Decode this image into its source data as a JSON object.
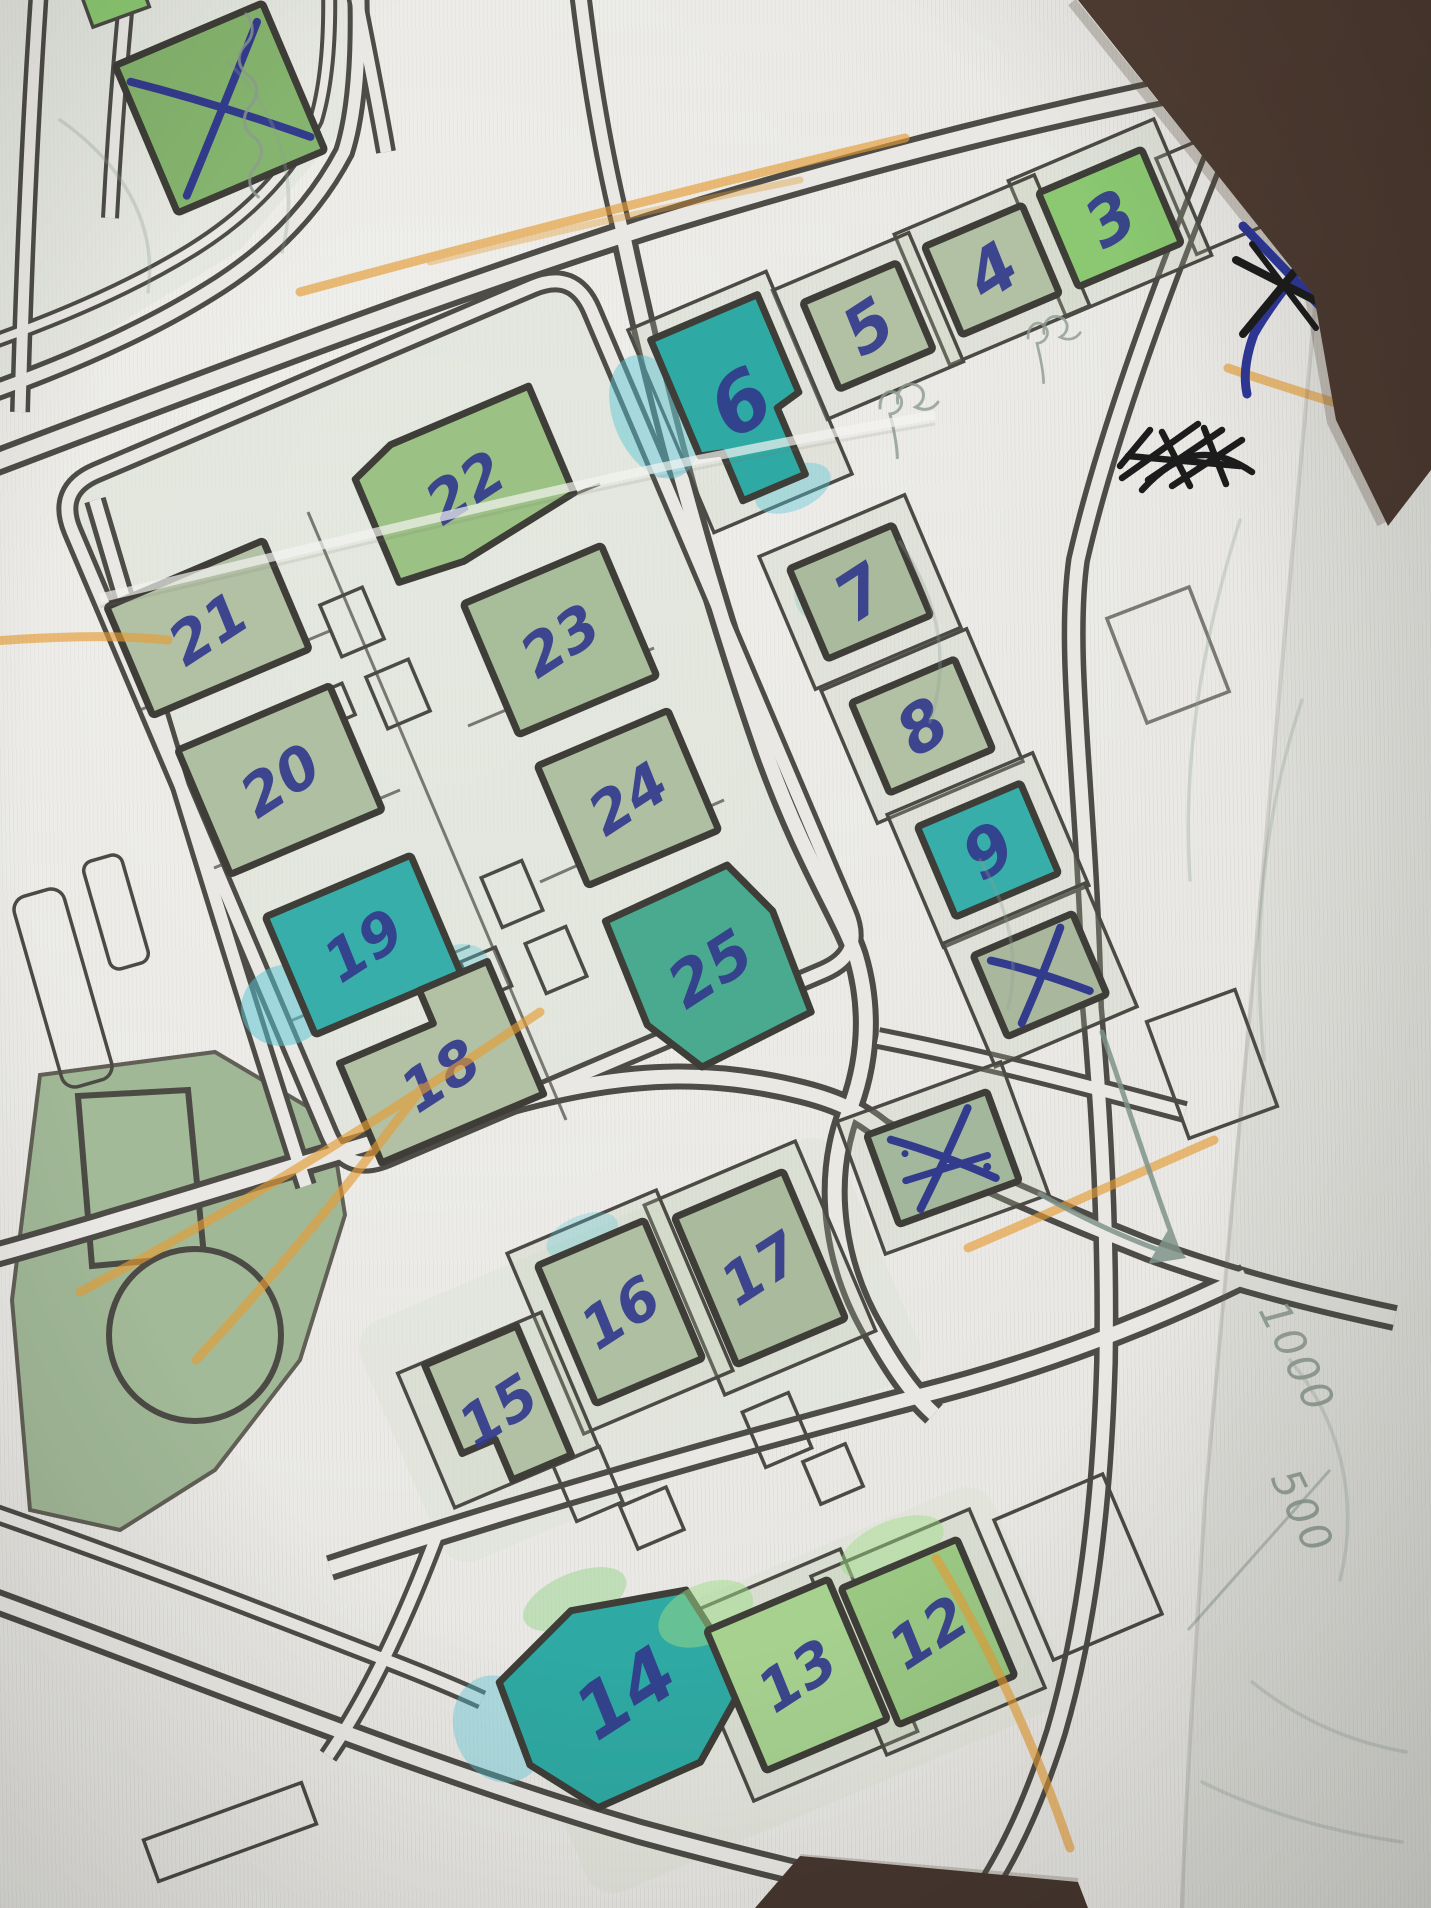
{
  "photo": {
    "scene": "hand-annotated printed street map lying on dark leather surface",
    "colors": {
      "table_brown": "#4c3a30",
      "paper": "#e9e8e4",
      "road_ink": "#4e4c47",
      "building_sage": "#b2c0a4",
      "highlight_green": "#8bc871",
      "highlight_teal": "#2fa9a3",
      "pen_blue": "#333b8c",
      "marker_orange": "#e59c35",
      "pencil_gray": "#8c9b90",
      "scribble_black": "#1c1c1c"
    }
  },
  "map": {
    "buildings": [
      {
        "id": "nw-crossed",
        "label": "",
        "cx": 220,
        "cy": 108,
        "rot": -23,
        "w": 160,
        "h": 160,
        "fill": "#85b46e",
        "crossed": true
      },
      {
        "id": "b3",
        "label": "3",
        "cx": 1110,
        "cy": 218,
        "rot": -23,
        "w": 112,
        "h": 102,
        "fill": "#8bc871",
        "lot": true
      },
      {
        "id": "b4",
        "label": "4",
        "cx": 992,
        "cy": 270,
        "rot": -23,
        "w": 106,
        "h": 96,
        "fill": "#b2c0a4",
        "lot": true
      },
      {
        "id": "b5",
        "label": "5",
        "cx": 868,
        "cy": 326,
        "rot": -23,
        "w": 102,
        "h": 94,
        "fill": "#b2c0a4",
        "lot": true
      },
      {
        "id": "b6",
        "label": "6",
        "cx": 740,
        "cy": 402,
        "rot": -23,
        "fs": 80,
        "points": "-58,-92 58,-92 58,14 32,20 32,92 -36,92 -36,40 -58,34",
        "fill": "#2fa9a3",
        "lot": true,
        "lw": 150,
        "lh": 220,
        "halos": [
          {
            "x": -85,
            "y": -20,
            "rx": 40,
            "ry": 65,
            "c": "#55c6d6",
            "o": 0.45
          },
          {
            "x": 15,
            "y": 100,
            "rx": 40,
            "ry": 22,
            "c": "#55c6d6",
            "o": 0.4
          }
        ]
      },
      {
        "id": "b7",
        "label": "7",
        "cx": 860,
        "cy": 592,
        "rot": -23,
        "w": 112,
        "h": 98,
        "fill": "#aaba9c",
        "lot": true,
        "halos": [
          {
            "x": -18,
            "y": -12,
            "rx": 46,
            "ry": 34,
            "c": "#64c0b4",
            "o": 0.25
          }
        ]
      },
      {
        "id": "b8",
        "label": "8",
        "cx": 922,
        "cy": 726,
        "rot": -23,
        "w": 112,
        "h": 98,
        "fill": "#b2c0a4",
        "lot": true
      },
      {
        "id": "b9",
        "label": "9",
        "cx": 988,
        "cy": 850,
        "rot": -23,
        "w": 112,
        "h": 98,
        "fill": "#38aeaa",
        "lot": true
      },
      {
        "id": "east-crossed",
        "label": "",
        "cx": 1040,
        "cy": 975,
        "rot": -23,
        "w": 108,
        "h": 88,
        "fill": "#a9b89d",
        "crossed": true,
        "lot": true
      },
      {
        "id": "b22",
        "label": "22",
        "cx": 465,
        "cy": 487,
        "rot": -23,
        "points": "-98,-50 -52,-68 98,-68 98,48 -30,68 -98,62",
        "fill": "#9cc184",
        "halos": [
          {
            "x": -45,
            "y": -25,
            "rx": 55,
            "ry": 40,
            "c": "#8cc46f",
            "o": 0.5
          }
        ]
      },
      {
        "id": "b23",
        "label": "23",
        "cx": 560,
        "cy": 640,
        "rot": -23,
        "w": 150,
        "h": 142,
        "fill": "#a8bd9a"
      },
      {
        "id": "b24",
        "label": "24",
        "cx": 628,
        "cy": 798,
        "rot": -23,
        "w": 142,
        "h": 130,
        "fill": "#afbfa2"
      },
      {
        "id": "b25",
        "label": "25",
        "cx": 710,
        "cy": 968,
        "rot": -23,
        "fs": 62,
        "points": "-78,-84 56,-88 80,-28 76,80 -46,88 -80,28",
        "fill": "#49aa8f",
        "halos": [
          {
            "x": 30,
            "y": -62,
            "rx": 40,
            "ry": 24,
            "c": "#55c6d6",
            "o": 0.35
          }
        ]
      },
      {
        "id": "b21",
        "label": "21",
        "cx": 208,
        "cy": 628,
        "rot": -23,
        "w": 170,
        "h": 118,
        "fill": "#b2c0a4"
      },
      {
        "id": "b20",
        "label": "20",
        "cx": 280,
        "cy": 780,
        "rot": -23,
        "w": 165,
        "h": 135,
        "fill": "#afbfa2"
      },
      {
        "id": "b19",
        "label": "19",
        "cx": 363,
        "cy": 945,
        "rot": -23,
        "w": 158,
        "h": 128,
        "fill": "#38aeaa",
        "halos": [
          {
            "x": -95,
            "y": 25,
            "rx": 45,
            "ry": 40,
            "c": "#55c6d6",
            "o": 0.5
          },
          {
            "x": 75,
            "y": 60,
            "rx": 35,
            "ry": 25,
            "c": "#55c6d6",
            "o": 0.35
          }
        ]
      },
      {
        "id": "b18",
        "label": "18",
        "cx": 440,
        "cy": 1075,
        "rot": -23,
        "points": "-88,-50 14,-50 14,-86 88,-86 88,58 -88,58",
        "fill": "#b2c0a4"
      },
      {
        "id": "mid-crossed",
        "label": "",
        "cx": 943,
        "cy": 1158,
        "rot": -20,
        "w": 128,
        "h": 95,
        "fill": "#a3b79c",
        "crossed": true,
        "messy": true,
        "lot": true
      },
      {
        "id": "b17",
        "label": "17",
        "cx": 760,
        "cy": 1268,
        "rot": -23,
        "w": 118,
        "h": 160,
        "fill": "#aaba9c",
        "lot": true
      },
      {
        "id": "b16",
        "label": "16",
        "cx": 620,
        "cy": 1312,
        "rot": -23,
        "w": 116,
        "h": 150,
        "fill": "#afbfa2",
        "lot": true,
        "halos": [
          {
            "x": -5,
            "y": -85,
            "rx": 38,
            "ry": 20,
            "c": "#55c6d6",
            "o": 0.3
          }
        ]
      },
      {
        "id": "b15",
        "label": "15",
        "cx": 498,
        "cy": 1410,
        "rot": -23,
        "points": "-50,-70 50,-70 50,70 -14,70 -14,26 -50,26",
        "fill": "#b2c0a4",
        "lot": true
      },
      {
        "id": "b14",
        "label": "14",
        "cx": 625,
        "cy": 1692,
        "rot": -23,
        "fs": 74,
        "points": "-112,-58 -18,-96 96,-70 114,38 42,94 -70,96 -116,30",
        "fill": "#2fa9a3",
        "halos": [
          {
            "x": -130,
            "y": -15,
            "rx": 45,
            "ry": 55,
            "c": "#55c6d6",
            "o": 0.4
          },
          {
            "x": -10,
            "y": -105,
            "rx": 55,
            "ry": 26,
            "c": "#8fd382",
            "o": 0.45
          }
        ]
      },
      {
        "id": "b13",
        "label": "13",
        "cx": 797,
        "cy": 1675,
        "rot": -23,
        "w": 132,
        "h": 152,
        "fill": "#a6d18f",
        "lot": true,
        "halos": [
          {
            "x": -60,
            "y": -92,
            "rx": 50,
            "ry": 30,
            "c": "#9edc86",
            "o": 0.5
          }
        ]
      },
      {
        "id": "b12",
        "label": "12",
        "cx": 928,
        "cy": 1632,
        "rot": -23,
        "w": 126,
        "h": 148,
        "fill": "#9ac883",
        "lot": true,
        "halos": [
          {
            "x": 0,
            "y": -92,
            "rx": 55,
            "ry": 26,
            "c": "#9edc86",
            "o": 0.45
          }
        ]
      }
    ],
    "handwriting": {
      "note_upper": "1000",
      "note_lower": "500"
    },
    "annotations": {
      "crossed_out_buildings": 3,
      "margin_cross_mark": "blue and black X on right paper edge",
      "black_scribble": "dense black pen scratch-out near top right",
      "orange_route_marks": 7,
      "pencil_arrow": "down-right arrow on right side",
      "illegible_pencil_notes": [
        "cursive-street-name-top-left",
        "initials-under-building-5",
        "initials-under-building-4"
      ]
    }
  }
}
